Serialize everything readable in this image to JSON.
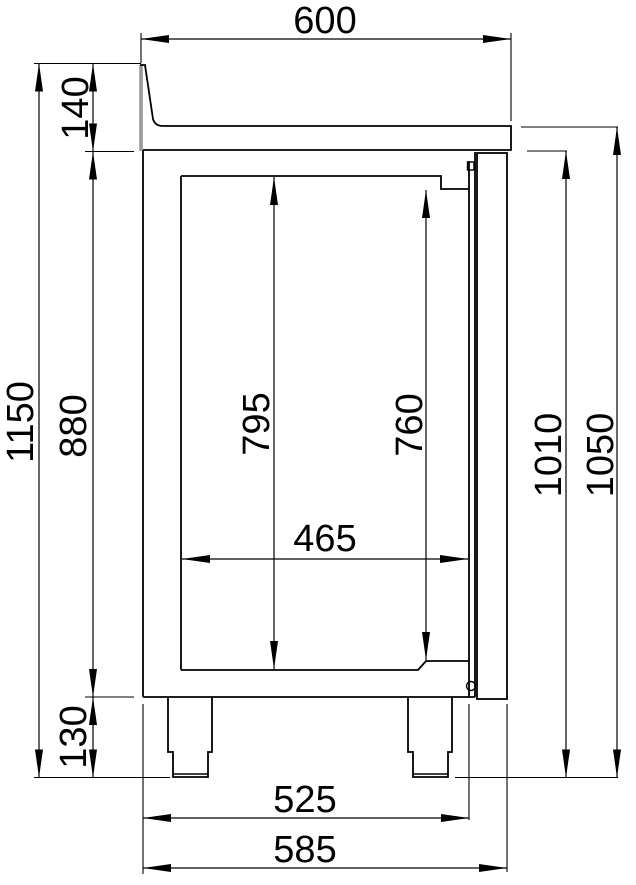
{
  "drawing": {
    "kind": "technical-dimension-drawing",
    "subject": "refrigerated counter side-view cross-section with splashback, door and legs",
    "unit": "mm",
    "colors": {
      "line": "#000000",
      "splashback_edge": "#9a9a9a",
      "background": "#ffffff"
    },
    "dimensions": {
      "worktop_depth": {
        "label": "600",
        "value": 600,
        "orientation": "horizontal",
        "location": "top"
      },
      "splashback_height": {
        "label": "140",
        "value": 140,
        "orientation": "vertical",
        "location": "upper-left"
      },
      "total_height": {
        "label": "1150",
        "value": 1150,
        "orientation": "vertical",
        "location": "far-left"
      },
      "body_height": {
        "label": "880",
        "value": 880,
        "orientation": "vertical",
        "location": "left"
      },
      "leg_height": {
        "label": "130",
        "value": 130,
        "orientation": "vertical",
        "location": "lower-left"
      },
      "interior_height": {
        "label": "795",
        "value": 795,
        "orientation": "vertical",
        "location": "interior-left"
      },
      "door_opening_height": {
        "label": "760",
        "value": 760,
        "orientation": "vertical",
        "location": "interior-right"
      },
      "interior_depth": {
        "label": "465",
        "value": 465,
        "orientation": "horizontal",
        "location": "interior"
      },
      "height_to_door_top": {
        "label": "1010",
        "value": 1010,
        "orientation": "vertical",
        "location": "right"
      },
      "height_to_worktop": {
        "label": "1050",
        "value": 1050,
        "orientation": "vertical",
        "location": "far-right"
      },
      "body_depth": {
        "label": "525",
        "value": 525,
        "orientation": "horizontal",
        "location": "bottom"
      },
      "overall_depth": {
        "label": "585",
        "value": 585,
        "orientation": "horizontal",
        "location": "bottom"
      }
    }
  }
}
